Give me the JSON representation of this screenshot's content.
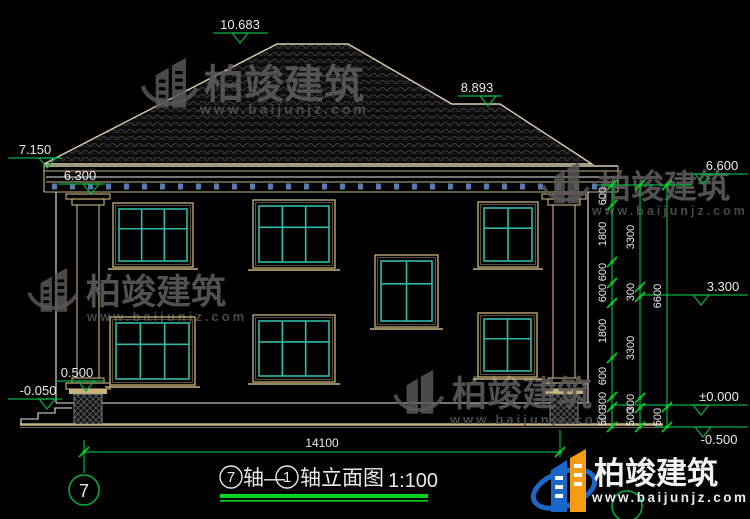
{
  "watermark": {
    "brand": "柏竣建筑",
    "url": "www.baijunjz.com"
  },
  "logo": {
    "brand": "柏竣建筑",
    "url": "www.baijunjz.com"
  },
  "drawing": {
    "title": {
      "axis_start_bubble": "7",
      "axis_text_1": "轴—",
      "axis_end_bubble": "1",
      "axis_text_2": "轴立面图",
      "scale": "1:100"
    },
    "axis_bubble_left": "7",
    "bottom_dimension": "14100",
    "levels": [
      {
        "label": "10.683",
        "line": [
          213,
          268
        ],
        "y": 33,
        "tip": 240,
        "text_x": 240,
        "text_side": "above"
      },
      {
        "label": "8.893",
        "line": [
          458,
          502
        ],
        "y": 96,
        "tip": 488,
        "text_x": 477,
        "text_side": "above"
      },
      {
        "label": "7.150",
        "line": [
          8,
          62
        ],
        "y": 158,
        "tip": 47,
        "text_x": 35,
        "text_side": "above"
      },
      {
        "label": "6.300",
        "line": [
          58,
          105
        ],
        "y": 184,
        "tip": 91,
        "text_x": 80,
        "text_side": "above"
      },
      {
        "label": "6.600",
        "line": [
          692,
          748
        ],
        "y": 174,
        "tip": 703,
        "text_x": 722,
        "text_side": "above"
      },
      {
        "label": "3.300",
        "line": [
          678,
          748
        ],
        "y": 295,
        "tip": 701,
        "text_x": 723,
        "text_side": "above"
      },
      {
        "label": "±0.000",
        "line": [
          683,
          748
        ],
        "y": 405,
        "tip": 701,
        "text_x": 719,
        "text_side": "above"
      },
      {
        "label": "-0.500",
        "line": [
          685,
          748
        ],
        "y": 427,
        "tip": 703,
        "text_x": 719,
        "text_side": "below"
      },
      {
        "label": "0.500",
        "line": [
          56,
          103
        ],
        "y": 381,
        "tip": 86,
        "text_x": 77,
        "text_side": "above"
      },
      {
        "label": "-0.050",
        "line": [
          8,
          62
        ],
        "y": 399,
        "tip": 47,
        "text_x": 38,
        "text_side": "above"
      }
    ],
    "dim_chains": [
      {
        "x": 612,
        "labels": [
          {
            "t": "600",
            "y": 196
          },
          {
            "t": "1800",
            "y": 234
          },
          {
            "t": "600",
            "y": 272
          },
          {
            "t": "600",
            "y": 293
          },
          {
            "t": "1800",
            "y": 331
          },
          {
            "t": "600",
            "y": 376
          },
          {
            "t": "300",
            "y": 401
          },
          {
            "t": "500",
            "y": 417
          }
        ],
        "ticks": [
          185,
          205,
          262,
          283,
          303,
          358,
          397,
          407,
          427
        ]
      },
      {
        "x": 640,
        "labels": [
          {
            "t": "3300",
            "y": 237
          },
          {
            "t": "300",
            "y": 292
          },
          {
            "t": "3300",
            "y": 348
          },
          {
            "t": "300",
            "y": 403
          },
          {
            "t": "500",
            "y": 417
          }
        ],
        "ticks": [
          185,
          287,
          297,
          398,
          408,
          427
        ]
      },
      {
        "x": 667,
        "labels": [
          {
            "t": "6600",
            "y": 296
          },
          {
            "t": "500",
            "y": 417
          }
        ],
        "ticks": [
          185,
          407,
          427
        ]
      }
    ],
    "windows": [
      {
        "x": 113,
        "y": 203,
        "w": 80,
        "h": 64,
        "cols": 3
      },
      {
        "x": 253,
        "y": 200,
        "w": 82,
        "h": 68,
        "cols": 3
      },
      {
        "x": 478,
        "y": 202,
        "w": 60,
        "h": 65,
        "cols": 2
      },
      {
        "x": 375,
        "y": 255,
        "w": 63,
        "h": 72,
        "cols": 2
      },
      {
        "x": 110,
        "y": 317,
        "w": 85,
        "h": 68,
        "cols": 3
      },
      {
        "x": 253,
        "y": 315,
        "w": 82,
        "h": 67,
        "cols": 3
      },
      {
        "x": 478,
        "y": 313,
        "w": 59,
        "h": 64,
        "cols": 2
      }
    ],
    "columns": [
      {
        "cx": 88
      },
      {
        "cx": 564
      }
    ]
  }
}
